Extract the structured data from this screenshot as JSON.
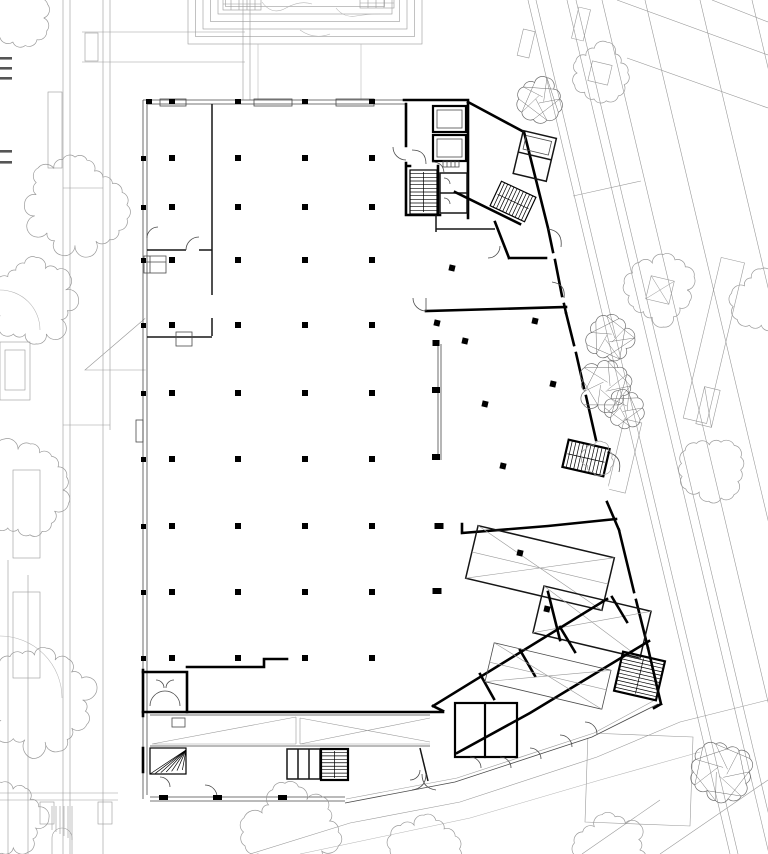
{
  "page": {
    "kind": "architectural-site-and-floor-plan",
    "paper_color": "#ffffff"
  },
  "colors": {
    "ink": "#000000",
    "wall": "#161616",
    "partition": "#4a4a4a",
    "site_line": "#9a9a9a",
    "site_light": "#b5b5b5"
  },
  "legend_dashes": {
    "x": 0,
    "width": 12,
    "height": 2.6,
    "ys": [
      57,
      67,
      77,
      150,
      161
    ],
    "color": "#555555"
  },
  "structure": {
    "column_size": 6,
    "grid_xs": [
      172,
      238,
      305,
      372
    ],
    "grid_ys": [
      158,
      207,
      260,
      325,
      393,
      459,
      526,
      592,
      658
    ],
    "extra_columns": [
      {
        "x": 452,
        "y": 268,
        "rot": 13
      },
      {
        "x": 437,
        "y": 323,
        "rot": 13
      },
      {
        "x": 465,
        "y": 341,
        "rot": 13
      },
      {
        "x": 535,
        "y": 321,
        "rot": 13
      },
      {
        "x": 553,
        "y": 384,
        "rot": 13
      },
      {
        "x": 485,
        "y": 404,
        "rot": 13
      },
      {
        "x": 503,
        "y": 466,
        "rot": 13
      },
      {
        "x": 520,
        "y": 553,
        "rot": 13
      },
      {
        "x": 547,
        "y": 609,
        "rot": 13
      },
      {
        "x": 439,
        "y": 526,
        "rot": 0,
        "w": 9
      },
      {
        "x": 437,
        "y": 591,
        "rot": 0,
        "w": 9
      },
      {
        "x": 436,
        "y": 390,
        "rot": 0,
        "w": 8
      },
      {
        "x": 436,
        "y": 457,
        "rot": 0,
        "w": 8
      },
      {
        "x": 436,
        "y": 343,
        "rot": 0,
        "w": 7
      }
    ],
    "facade_ticks": {
      "top": {
        "y": 99,
        "xs": [
          149,
          172,
          238,
          305,
          372
        ]
      },
      "west": {
        "x": 141,
        "ys": [
          158,
          207,
          260,
          325,
          393,
          459,
          526,
          592,
          658
        ]
      },
      "south": {
        "y": 795,
        "xs": [
          163,
          217,
          282
        ]
      }
    }
  },
  "stairs": [
    {
      "name": "stair-ne-core",
      "x": 410,
      "y": 170,
      "w": 27,
      "h": 44,
      "rot": 0,
      "lines": 11,
      "dir": "h",
      "sw": 1.2
    },
    {
      "name": "stair-ne-diag",
      "x": 494,
      "y": 188,
      "w": 38,
      "h": 27,
      "rot": 25,
      "lines": 10,
      "dir": "v",
      "sw": 1.2
    },
    {
      "name": "stair-east",
      "x": 565,
      "y": 444,
      "w": 42,
      "h": 28,
      "rot": 13,
      "lines": 10,
      "dir": "v",
      "sw": 2.2
    },
    {
      "name": "stair-se",
      "x": 618,
      "y": 656,
      "w": 43,
      "h": 40,
      "rot": 13,
      "lines": 10,
      "dir": "h",
      "sw": 2.2
    },
    {
      "name": "stair-sw-spiral",
      "x": 321,
      "y": 749,
      "w": 27,
      "h": 31,
      "rot": 0,
      "lines": 8,
      "dir": "h",
      "sw": 2.2
    },
    {
      "name": "stair-sw-winder",
      "x": 150,
      "y": 748,
      "w": 36,
      "h": 26,
      "rot": 0,
      "lines": 7,
      "dir": "fan",
      "sw": 1.2
    }
  ],
  "trees": {
    "fluffy": [
      {
        "x": 22,
        "y": 18,
        "r": 26
      },
      {
        "x": 75,
        "y": 205,
        "r": 48
      },
      {
        "x": 33,
        "y": 300,
        "r": 42
      },
      {
        "x": 18,
        "y": 490,
        "r": 48
      },
      {
        "x": 40,
        "y": 700,
        "r": 52
      },
      {
        "x": 8,
        "y": 818,
        "r": 36
      },
      {
        "x": 600,
        "y": 73,
        "r": 28,
        "square": true
      },
      {
        "x": 660,
        "y": 290,
        "r": 33,
        "square": true,
        "diag": true
      },
      {
        "x": 712,
        "y": 470,
        "r": 30
      },
      {
        "x": 764,
        "y": 300,
        "r": 30
      },
      {
        "x": 292,
        "y": 832,
        "r": 44
      },
      {
        "x": 424,
        "y": 849,
        "r": 32
      },
      {
        "x": 612,
        "y": 850,
        "r": 34
      },
      {
        "x": 598,
        "y": 458,
        "r": 15
      }
    ],
    "faceted": [
      {
        "x": 540,
        "y": 99,
        "r": 20
      },
      {
        "x": 610,
        "y": 338,
        "r": 22
      },
      {
        "x": 605,
        "y": 386,
        "r": 25
      },
      {
        "x": 624,
        "y": 408,
        "r": 19
      },
      {
        "x": 722,
        "y": 772,
        "r": 28
      }
    ]
  }
}
